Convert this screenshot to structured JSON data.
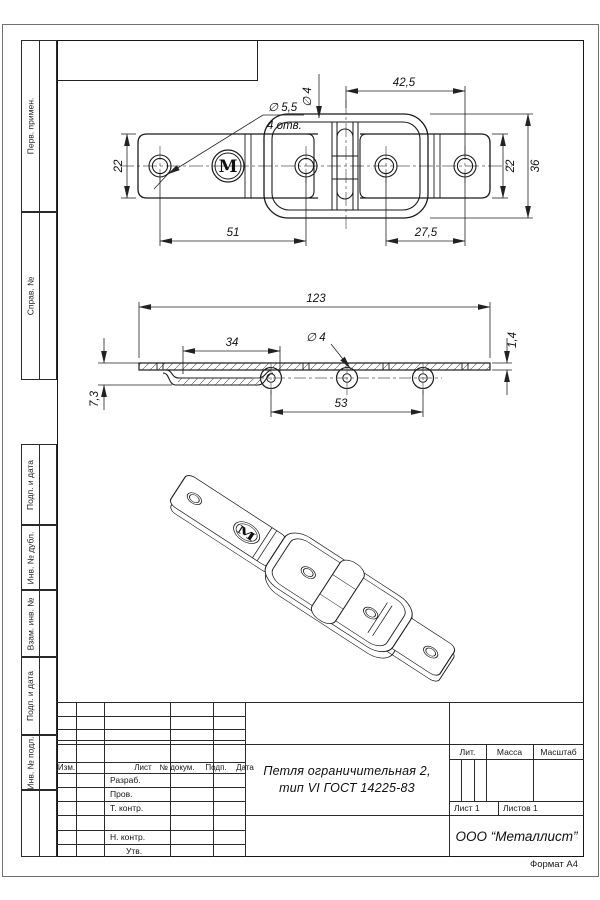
{
  "sheet": {
    "format_note": "Формат А4"
  },
  "margin_boxes": [
    {
      "label": "Перв. примен."
    },
    {
      "label": "Справ. №"
    },
    {
      "label": "Подп. и дата"
    },
    {
      "label": "Инв. № дубл."
    },
    {
      "label": "Взам. инв. №"
    },
    {
      "label": "Подп. и дата"
    },
    {
      "label": "Инв. № подл."
    }
  ],
  "title_block": {
    "rev_header": {
      "izm": "Изм.",
      "list": "Лист",
      "dokum": "№ докум.",
      "podp": "Подп.",
      "data": "Дата"
    },
    "sign_rows": [
      "Разраб.",
      "Пров.",
      "Т. контр.",
      "Н. контр.",
      "Утв."
    ],
    "doc_title_line1": "Петля ограничительная 2,",
    "doc_title_line2": "тип VI ГОСТ 14225-83",
    "lit_label": "Лит.",
    "mass_label": "Масса",
    "scale_label": "Масштаб",
    "sheet_no": "Лист 1",
    "sheets_total": "Листов 1",
    "company": "ООО “Металлист”"
  },
  "views": {
    "logo_letter": "M",
    "top": {
      "hole_dia": "∅ 5,5",
      "hole_qty": "4 отв.",
      "pin_dia": "∅ 4",
      "w_42_5": "42,5",
      "h_22_left": "22",
      "h_22_right": "22",
      "h_36": "36",
      "w_51": "51",
      "w_27_5": "27,5"
    },
    "side": {
      "w_123": "123",
      "w_34": "34",
      "pin_dia": "∅ 4",
      "t_1_4": "1,4",
      "h_7_3": "7,3",
      "w_53": "53"
    }
  }
}
